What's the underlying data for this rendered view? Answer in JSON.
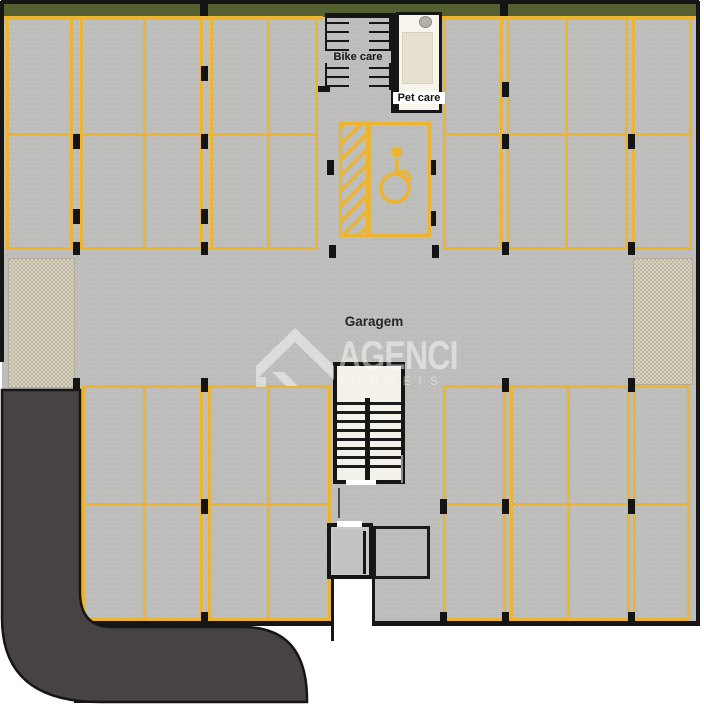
{
  "plan": {
    "width": 704,
    "height": 707,
    "labels": {
      "garage": "Garagem",
      "bike_care": "Bike care",
      "pet_care": "Pet care"
    },
    "watermark": {
      "brand": "AGENCI",
      "subtitle": "IMÓVEIS"
    },
    "colors": {
      "parking_line_yellow": "#ecb42f",
      "concrete_floor": "#bdbdbb",
      "perimeter_green": "#546030",
      "driveway_dark": "#474243",
      "paver_beige": "#cdc6b3",
      "wall_black": "#161616",
      "room_cream": "#f4f1e8"
    },
    "icons": {
      "accessible_parking": "wheelchair-icon",
      "bike_rack": "bike-rack-icon",
      "pet_sink": "sink-icon"
    },
    "parking_blocks": [
      {
        "x": 6,
        "y": 17,
        "w": 312,
        "h": 233,
        "rows": [
          133
        ],
        "vlines": [
          70,
          80,
          143,
          200,
          210,
          267
        ]
      },
      {
        "x": 443,
        "y": 17,
        "w": 249,
        "h": 233,
        "rows": [
          133
        ],
        "vlines": [
          500,
          507,
          565,
          625,
          632
        ]
      },
      {
        "x": 82,
        "y": 385,
        "w": 249,
        "h": 236,
        "rows": [
          503
        ],
        "vlines": [
          143,
          200,
          208,
          267
        ]
      },
      {
        "x": 443,
        "y": 385,
        "w": 247,
        "h": 236,
        "rows": [
          503
        ],
        "vlines": [
          503,
          510,
          567,
          627,
          633
        ]
      }
    ],
    "column_markers": [
      [
        200,
        3,
        8,
        13
      ],
      [
        500,
        3,
        8,
        13
      ],
      [
        201,
        66,
        7,
        15
      ],
      [
        73,
        134,
        7,
        15
      ],
      [
        201,
        134,
        7,
        15
      ],
      [
        73,
        209,
        7,
        15
      ],
      [
        201,
        209,
        7,
        15
      ],
      [
        73,
        242,
        7,
        13
      ],
      [
        201,
        242,
        7,
        13
      ],
      [
        327,
        160,
        7,
        15
      ],
      [
        429,
        160,
        7,
        15
      ],
      [
        429,
        211,
        7,
        15
      ],
      [
        329,
        245,
        7,
        13
      ],
      [
        432,
        245,
        7,
        13
      ],
      [
        502,
        82,
        7,
        15
      ],
      [
        502,
        134,
        7,
        15
      ],
      [
        628,
        134,
        7,
        15
      ],
      [
        502,
        242,
        7,
        13
      ],
      [
        628,
        242,
        7,
        13
      ],
      [
        73,
        378,
        7,
        14
      ],
      [
        201,
        378,
        7,
        14
      ],
      [
        502,
        378,
        7,
        14
      ],
      [
        628,
        378,
        7,
        14
      ],
      [
        73,
        499,
        7,
        15
      ],
      [
        201,
        499,
        7,
        15
      ],
      [
        440,
        499,
        7,
        15
      ],
      [
        502,
        499,
        7,
        15
      ],
      [
        628,
        499,
        7,
        15
      ],
      [
        73,
        612,
        7,
        12
      ],
      [
        201,
        612,
        7,
        12
      ],
      [
        440,
        612,
        7,
        12
      ],
      [
        502,
        612,
        7,
        12
      ],
      [
        628,
        612,
        7,
        12
      ]
    ],
    "road_markers": [
      [
        74,
        694,
        24,
        9
      ],
      [
        140,
        694,
        24,
        9
      ],
      [
        214,
        694,
        24,
        9
      ]
    ]
  }
}
